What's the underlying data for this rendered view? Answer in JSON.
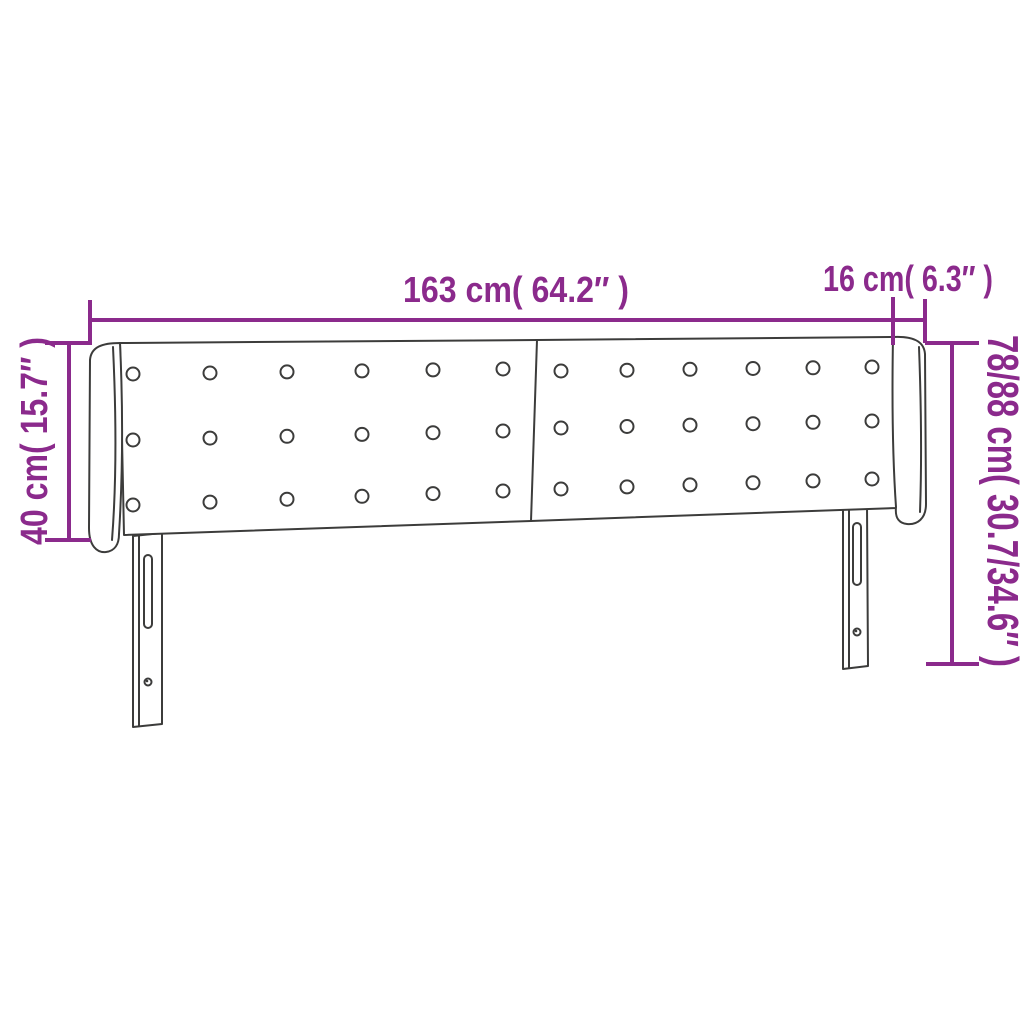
{
  "figure": {
    "name": "upholstered-headboard-dimension-diagram",
    "background": "#ffffff",
    "line_art_color": "#3c3c3b",
    "dimension_color": "#8b2a8c",
    "labels": {
      "width_main": "163 cm( 64.2″ )",
      "width_wing": "16 cm( 6.3″ )",
      "height_side": "40 cm( 15.7″ )",
      "height_total": "78/88 cm( 30.7/34.6″ )"
    }
  }
}
